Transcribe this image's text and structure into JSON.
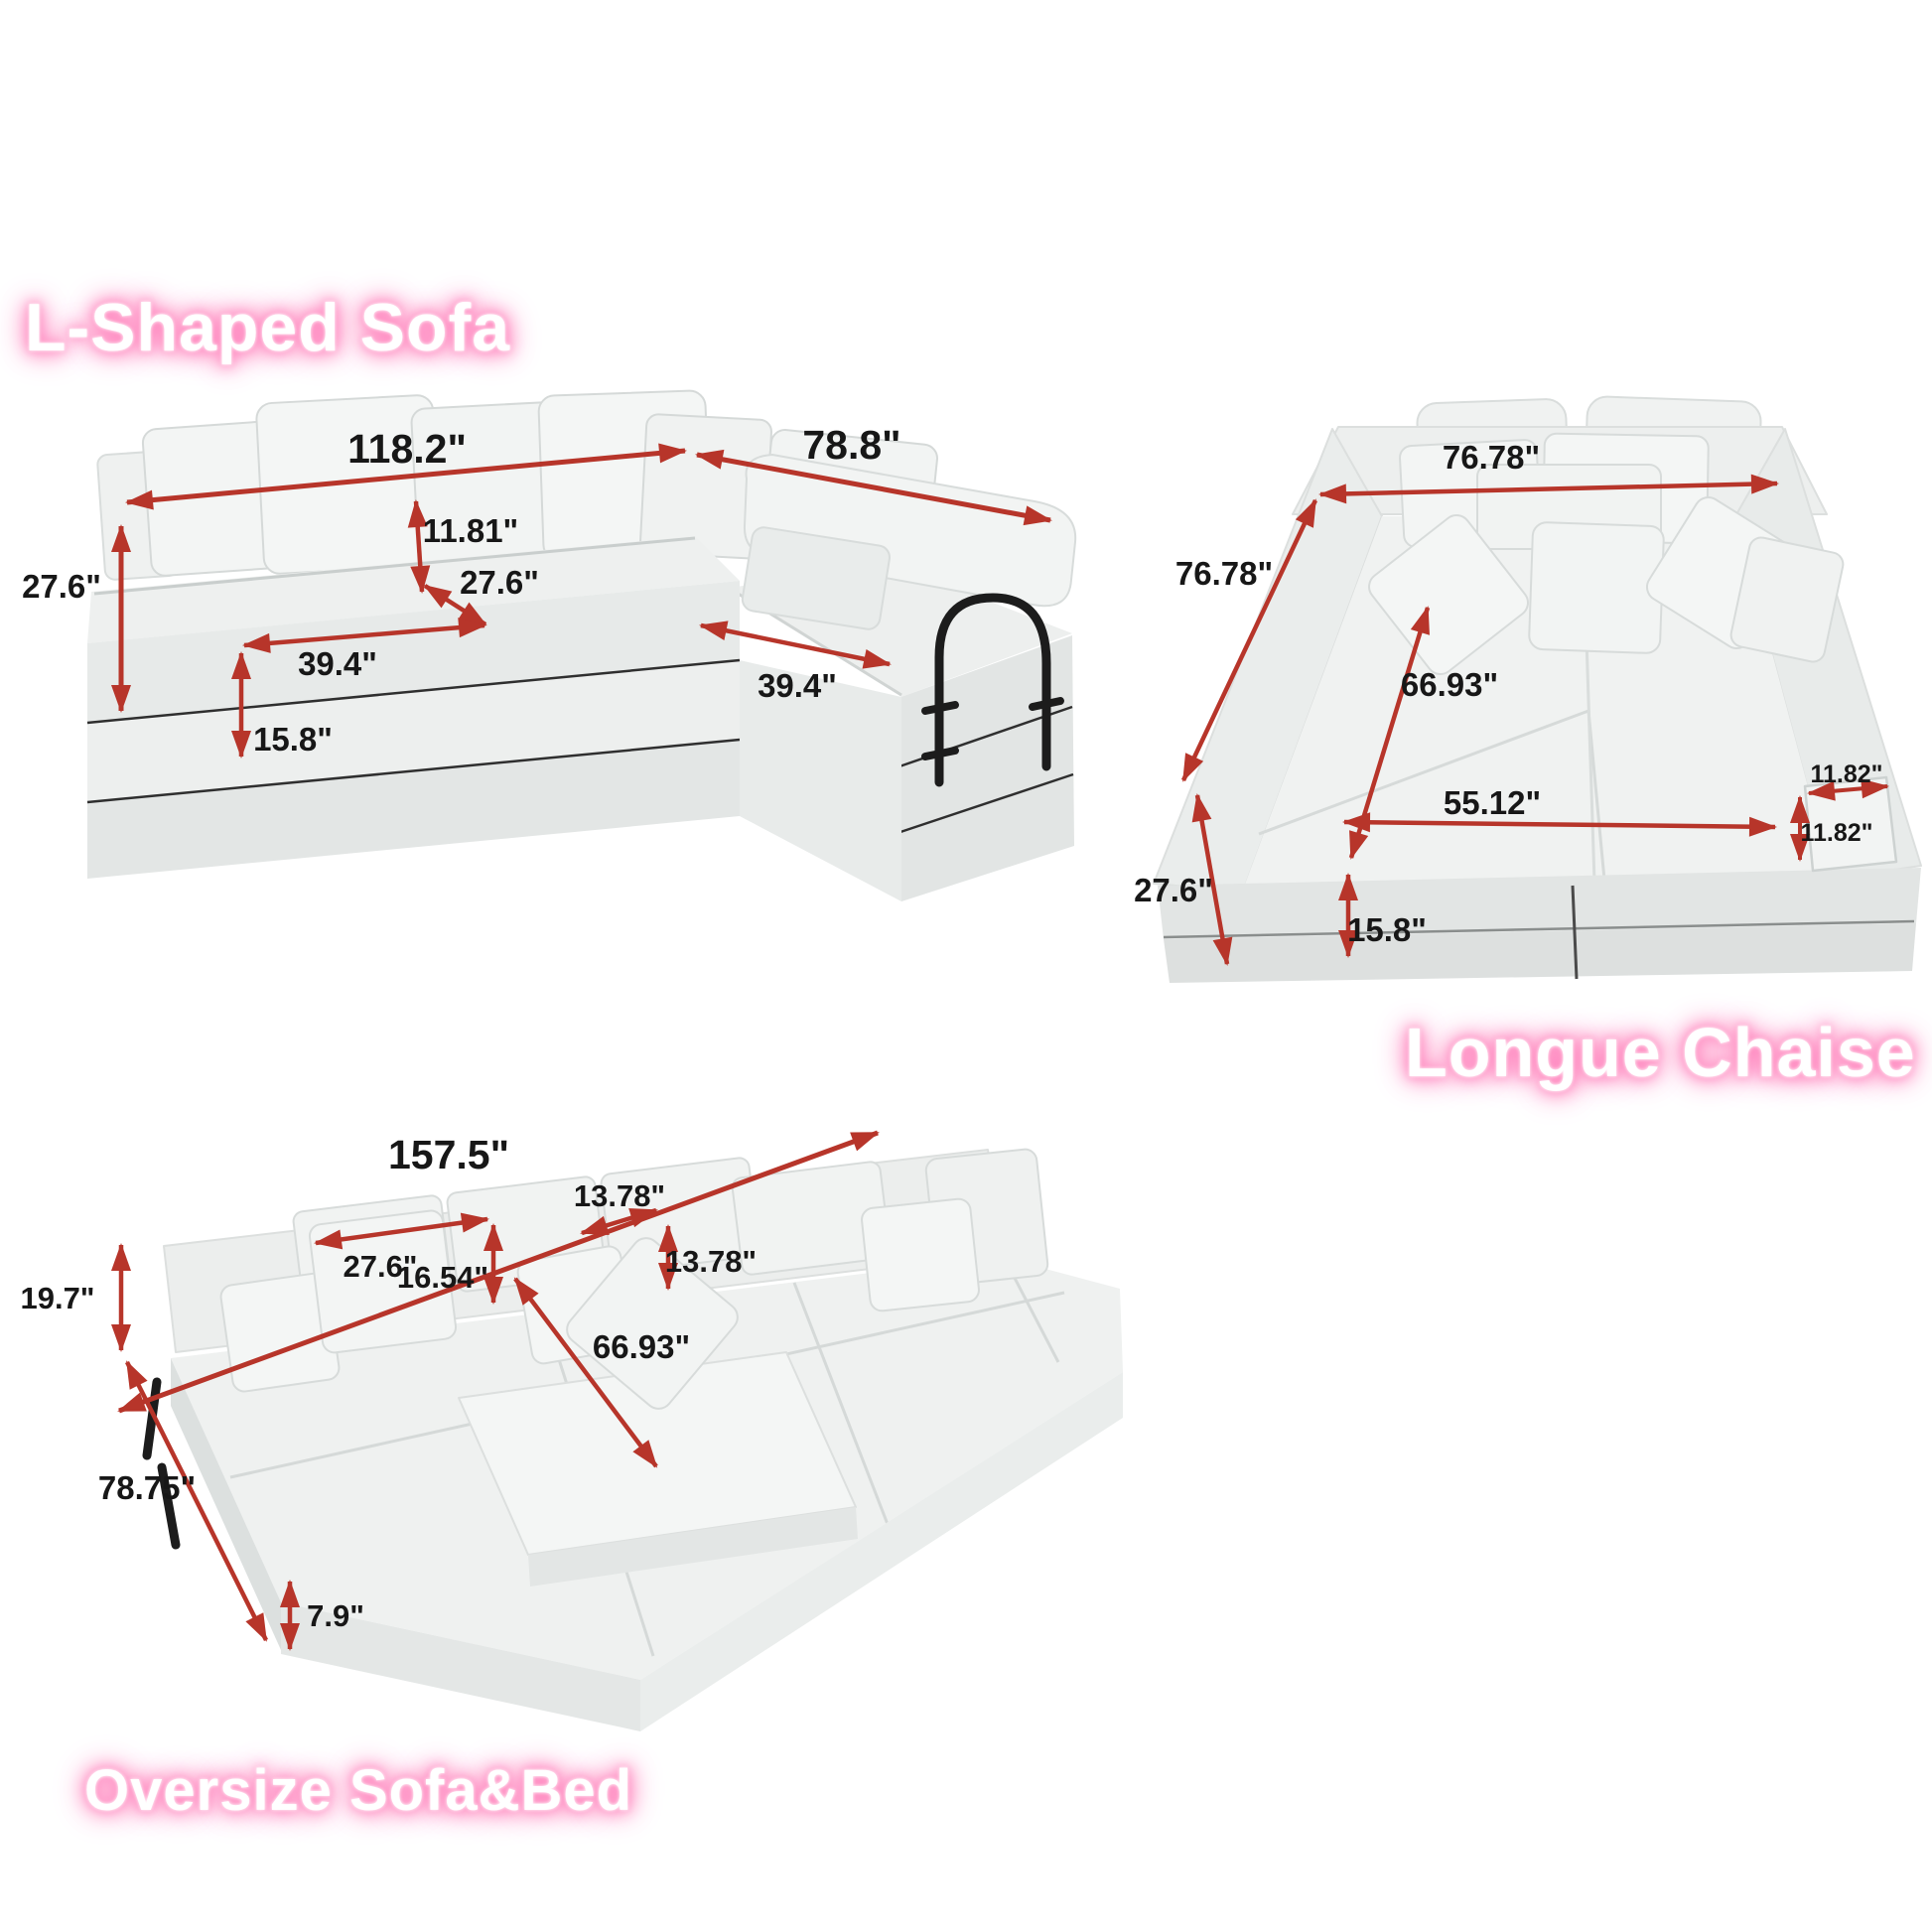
{
  "sheet": {
    "unit": "inches"
  },
  "colors": {
    "arrow_red": "#b7352a",
    "label_black": "#171717",
    "title_white": "#ffffff",
    "title_glow_pink": "#ff7ab8",
    "sofa_light": "#f1f3f2",
    "sofa_mid": "#e9eceb",
    "sofa_dark": "#dfe3e2",
    "seam_dark": "#2f2f2f",
    "metal_black": "#1c1c1c",
    "background": "#ffffff"
  },
  "figures": {
    "l_shaped_sofa": {
      "title": "L-Shaped Sofa",
      "dimensions": {
        "total_length": "118.2\"",
        "chaise_length": "78.8\"",
        "overall_height": "27.6\"",
        "back_pillow_height": "11.81\"",
        "seat_depth": "27.6\"",
        "left_seat_width": "39.4\"",
        "right_seat_width": "39.4\"",
        "base_height": "15.8\""
      }
    },
    "longue_chaise": {
      "title": "Longue Chaise",
      "dimensions": {
        "total_width": "76.78\"",
        "total_depth": "76.78\"",
        "inner_diagonal": "66.93\"",
        "seat_width": "55.12\"",
        "armrest_top_width": "11.82\"",
        "armrest_side_width": "11.82\"",
        "overall_height": "27.6\"",
        "base_height": "15.8\""
      }
    },
    "oversize_sofa_bed": {
      "title": "Oversize Sofa&Bed",
      "dimensions": {
        "total_length": "157.5\"",
        "back_cushion_width": "27.6\"",
        "back_cushion_height": "16.54\"",
        "pillow_width": "13.78\"",
        "pillow_height": "13.78\"",
        "back_height": "19.7\"",
        "bed_diagonal": "66.93\"",
        "total_depth": "78.75\"",
        "mattress_height": "7.9\""
      }
    }
  }
}
